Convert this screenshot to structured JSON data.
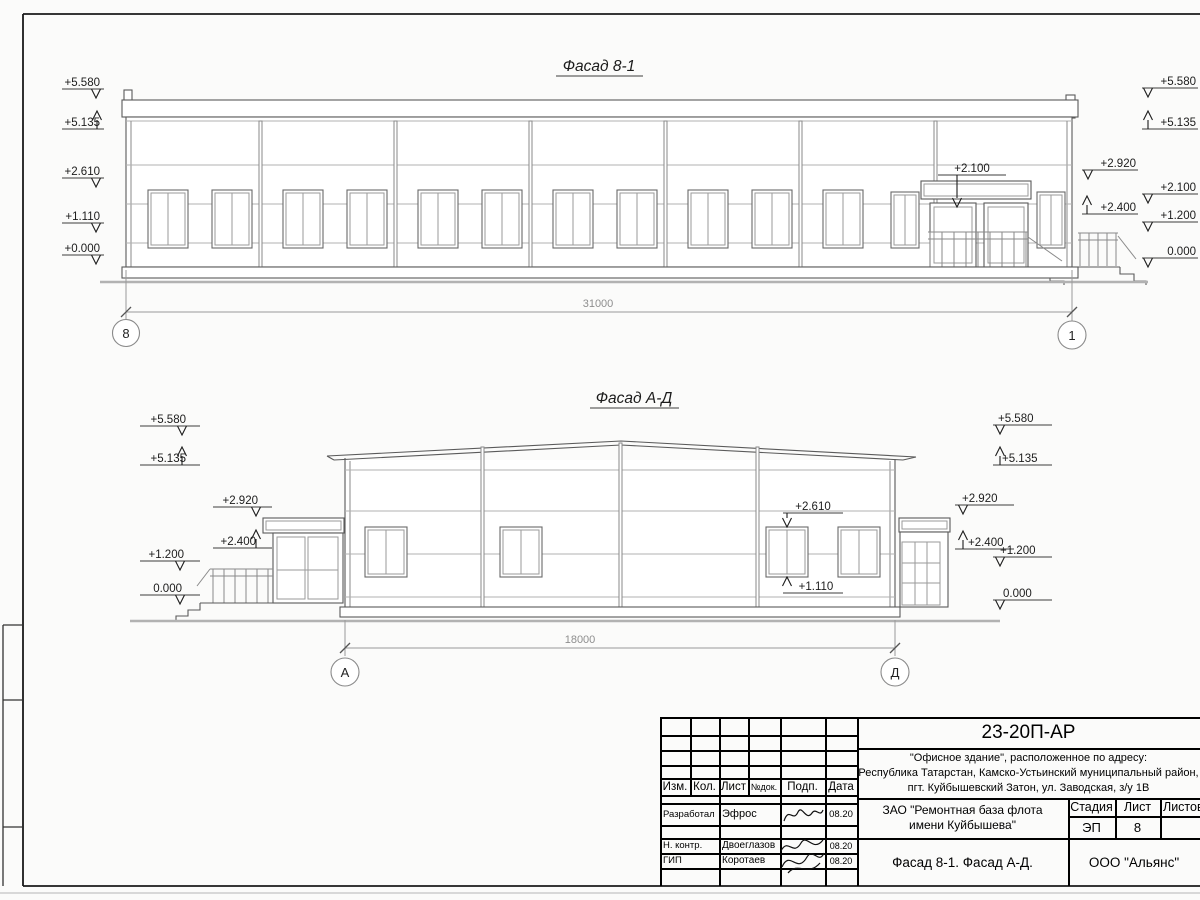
{
  "drawing": {
    "facade1": {
      "title": "Фасад 8-1",
      "dim": "31000",
      "axis_left": "8",
      "axis_right": "1",
      "canopy_mark": "+2.100",
      "ml": [
        "+5.580",
        "+5.135",
        "+2.610",
        "+1.110",
        "+0.000"
      ],
      "mr_inner": [
        "+2.920",
        "+2.400"
      ],
      "mr_outer": [
        "+5.580",
        "+5.135",
        "+2.100",
        "+1.200",
        "0.000"
      ]
    },
    "facade2": {
      "title": "Фасад А-Д",
      "dim": "18000",
      "axis_left": "А",
      "axis_right": "Д",
      "win_top_mark": "+2.610",
      "win_bottom_mark": "+1.110",
      "ml_outer": [
        "+5.580",
        "+5.135",
        "+1.200",
        "0.000"
      ],
      "ml_inner": [
        "+2.920",
        "+2.400"
      ],
      "mr_inner": [
        "+2.920",
        "+2.400"
      ],
      "mr_outer": [
        "+5.580",
        "+5.135",
        "+1.200",
        "0.000"
      ]
    }
  },
  "titleblock": {
    "doc_number": "23-20П-АР",
    "address1": "\"Офисное здание\", расположенное по адресу:",
    "address2": "Республика Татарстан, Камско-Устьинский муниципальный район,",
    "address3": "пгт. Куйбышевский Затон, ул. Заводская, з/у 1В",
    "client1": "ЗАО \"Ремонтная база флота",
    "client2": "имени Куйбышева\"",
    "sheet_title": "Фасад 8-1. Фасад А-Д.",
    "company": "ООО \"Альянс\"",
    "cols": {
      "izm": "Изм.",
      "kol": "Кол.",
      "list": "Лист",
      "ndok": "№док.",
      "podp": "Подп.",
      "data": "Дата"
    },
    "stage_label": "Стадия",
    "list_label": "Лист",
    "listov_label": "Листов",
    "stage": "ЭП",
    "sheet_no": "8",
    "rows": [
      {
        "role": "Разработал",
        "name": "Эфрос",
        "date": "08.20"
      },
      {
        "role": "Н. контр.",
        "name": "Двоеглазов",
        "date": "08.20"
      },
      {
        "role": "ГИП",
        "name": "Коротаев",
        "date": "08.20"
      }
    ]
  }
}
